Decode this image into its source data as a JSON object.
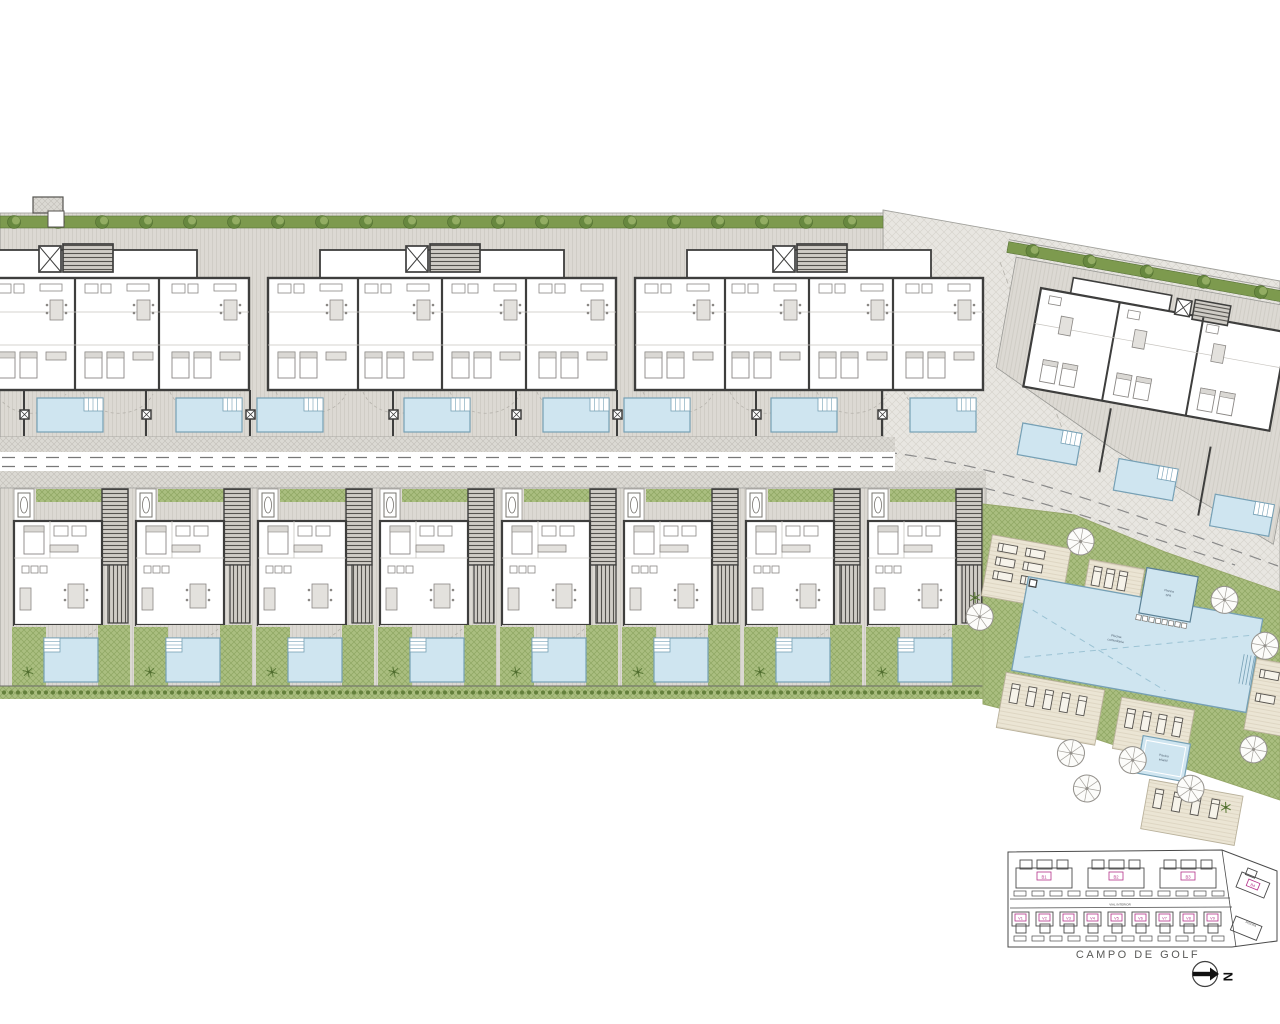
{
  "legend": {
    "caption": "CAMPO DE GOLF",
    "road_label": "VIAL INTERIOR",
    "pool_area_label": "PISCINA",
    "north_label": "N",
    "building_labels": [
      "B1",
      "B2",
      "B3",
      "B4"
    ],
    "villa_labels": [
      "V1",
      "V2",
      "V3",
      "V4",
      "V5",
      "V6",
      "V7",
      "V8",
      "V9"
    ]
  },
  "communal": {
    "main_pool_label": [
      "Piscina",
      "comunitaria"
    ],
    "spa_label": [
      "Piscina",
      "SPA"
    ],
    "kids_pool_label": [
      "Piscina",
      "infantil"
    ]
  },
  "site": {
    "upper_building_count": 3,
    "upper_private_pool_count": 8,
    "villa_count": 8,
    "right_block_pool_count": 3,
    "hedge_tree_spacing": 44
  },
  "colors": {
    "pool_fill": "#cfe5f0",
    "pool_edge": "#76a0b5",
    "lawn": "#aabe80",
    "lawn_line": "#8ea662",
    "hedge": "#7d9a4e",
    "tree_dark": "#67883f",
    "tree_light": "#93ad63",
    "wall": "#3e3e3d",
    "band": "#dcd9d3",
    "paving": "#e8e6e1",
    "deck": "#ebe5d4",
    "furn": "#8a8784",
    "label_magenta": "#b5338a",
    "ink": "#4a4a4a"
  }
}
